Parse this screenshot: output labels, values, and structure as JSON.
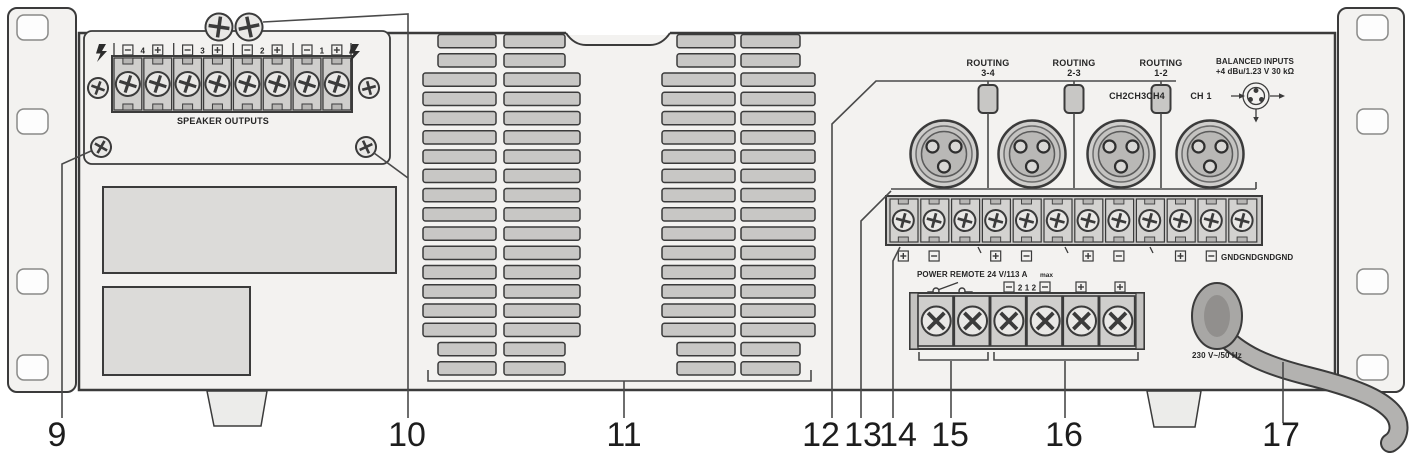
{
  "figure": {
    "description_label": "amplifier rear panel diagram",
    "colors": {
      "background": "#ffffff",
      "panel": "#f3f2f0",
      "line": "#3b3b3b",
      "slot_fill": "#c8c7c5",
      "metal_fill": "#d3d2d0",
      "cable": "#b3b2b0",
      "text": "#262626"
    },
    "speaker_outputs": {
      "section_label": "SPEAKER OUTPUTS",
      "channels": [
        "4",
        "3",
        "2",
        "1"
      ],
      "minus_sign": "−",
      "plus_sign": "+"
    },
    "routing_switches": [
      {
        "line1": "ROUTING",
        "line2": "3-4"
      },
      {
        "line1": "ROUTING",
        "line2": "2-3"
      },
      {
        "line1": "ROUTING",
        "line2": "1-2"
      }
    ],
    "channel_labels": {
      "group": "CH2CH3CH4",
      "single": "CH 1"
    },
    "balanced_inputs": {
      "title": "BALANCED INPUTS",
      "spec": "+4 dBu/1.23 V 30 kΩ"
    },
    "input_terminal_strip": {
      "plus_sign": "+",
      "minus_sign": "−",
      "ground_label": "GNDGNDGNDGND"
    },
    "power_remote": {
      "label": "POWER REMOTE 24 V/113 A",
      "max_label": "max",
      "terminal_row_numbers": "2 1 2",
      "minus_sign": "−",
      "plus_sign": "+"
    },
    "mains": {
      "voltage_label": "230 V~/50 Hz"
    },
    "callouts": [
      {
        "number": "9"
      },
      {
        "number": "10"
      },
      {
        "number": "11"
      },
      {
        "number": "12"
      },
      {
        "number": "13"
      },
      {
        "number": "14"
      },
      {
        "number": "15"
      },
      {
        "number": "16"
      },
      {
        "number": "17"
      }
    ]
  }
}
